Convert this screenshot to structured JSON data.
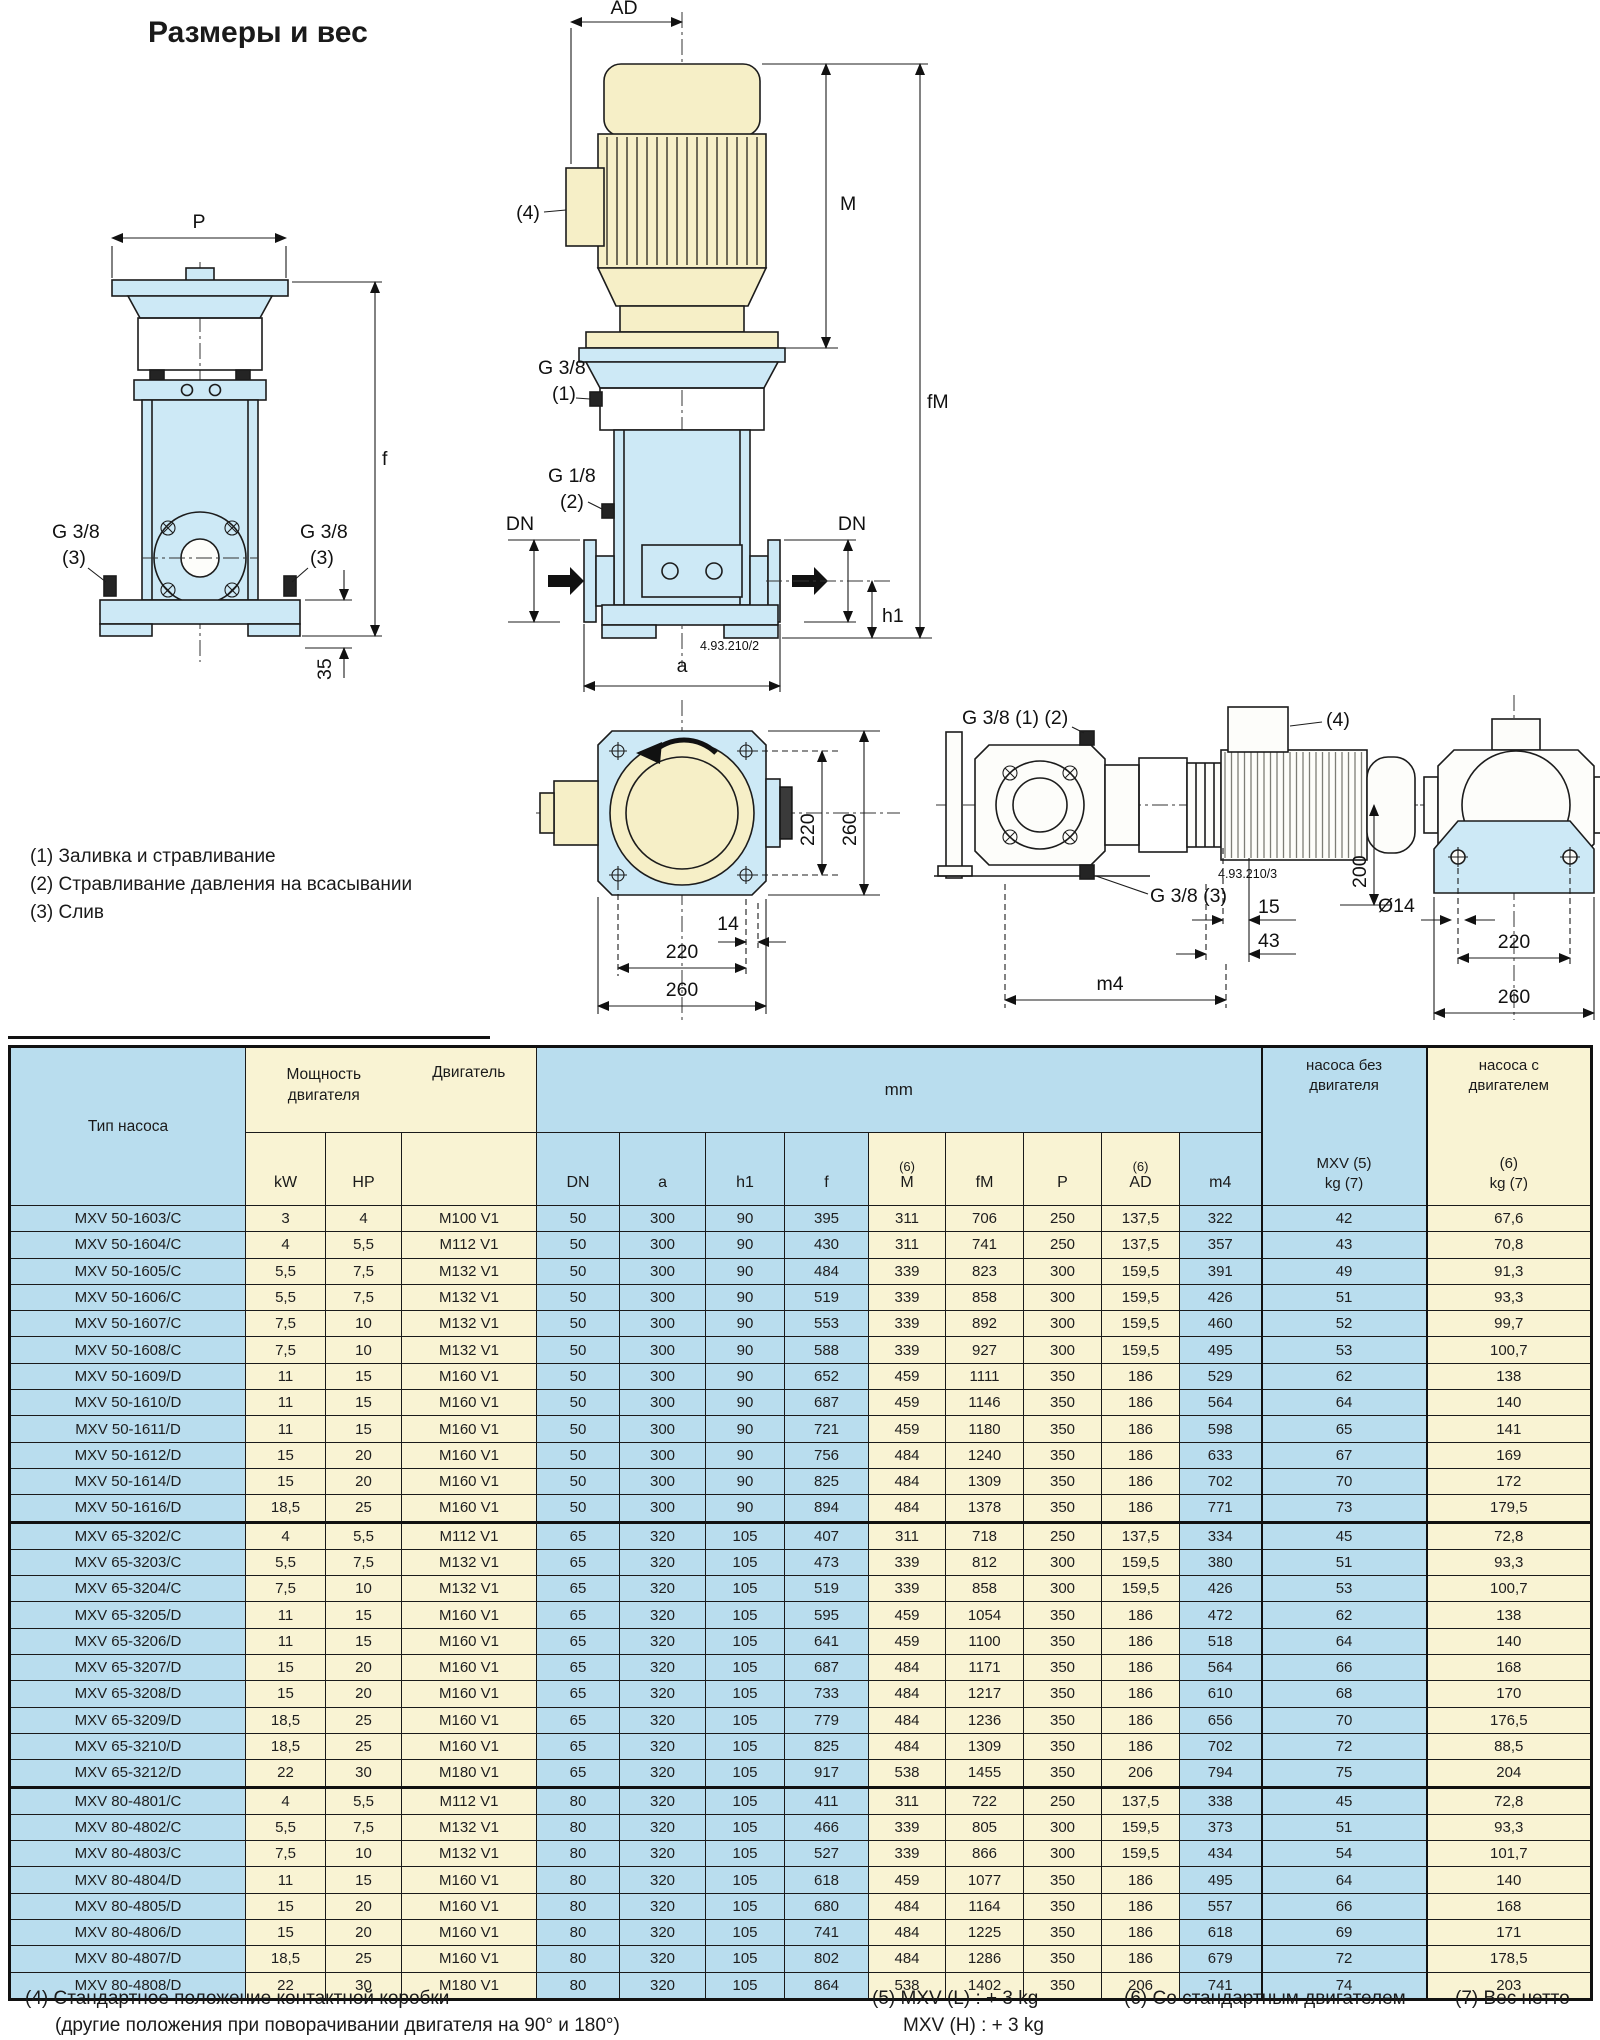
{
  "title": "Размеры и вес",
  "colors": {
    "table_blue": "#b9ddee",
    "table_cream": "#f9f3d3",
    "drawing_blue": "#cde9f6",
    "drawing_cream": "#f6efc7",
    "line": "#1c1c1c"
  },
  "notes": {
    "n1": "(1) Заливка и стравливание",
    "n2": "(2) Стравливание давления на всасывании",
    "n3": "(3) Слив"
  },
  "drawings": {
    "front": {
      "p": "P",
      "f": "f",
      "g38_left_1": "G 3/8",
      "g38_left_2": "(3)",
      "g38_right_1": "G 3/8",
      "g38_right_2": "(3)",
      "d35": "35"
    },
    "center": {
      "ad": "AD",
      "ref4": "(4)",
      "m": "M",
      "fm": "fM",
      "g38_1": "G 3/8",
      "g38_2": "(1)",
      "g18_1": "G 1/8",
      "g18_2": "(2)",
      "dn_left": "DN",
      "dn_right": "DN",
      "h1": "h1",
      "a": "a",
      "code": "4.93.210/2"
    },
    "plan": {
      "v220": "220",
      "v260": "260",
      "d14": "14",
      "h220": "220",
      "h260": "260"
    },
    "side": {
      "g38_12": "G 3/8 (1) (2)",
      "g38_3": "G 3/8 (3)",
      "ref4": "(4)",
      "code": "4.93.210/3",
      "d200": "200",
      "d15": "15",
      "d43": "43",
      "m4": "m4"
    },
    "endv": {
      "d14": "Ø14",
      "d220": "220",
      "d260": "260"
    }
  },
  "table": {
    "header": {
      "type": "Тип насоса",
      "power_l1": "Мощность",
      "power_l2": "двигателя",
      "motor": "Двигатель",
      "kw": "kW",
      "hp": "HP",
      "mm": "mm",
      "dn": "DN",
      "a": "a",
      "h1": "h1",
      "f": "f",
      "m_sup": "(6)",
      "m": "M",
      "fm": "fM",
      "p": "P",
      "ad_sup": "(6)",
      "ad": "AD",
      "m4": "m4",
      "kg1_l1": "насоса без",
      "kg1_l2": "двигателя",
      "kg1_l3": "MXV (5)",
      "kg1_l4": "kg (7)",
      "kg2_l1": "насоса с",
      "kg2_l2": "двигателем",
      "kg2_l3": "(6)",
      "kg2_l4": "kg (7)"
    },
    "groups": [
      [
        [
          "MXV 50-1603/C",
          "3",
          "4",
          "M100 V1",
          "50",
          "300",
          "90",
          "395",
          "311",
          "706",
          "250",
          "137,5",
          "322",
          "42",
          "67,6"
        ],
        [
          "MXV 50-1604/C",
          "4",
          "5,5",
          "M112 V1",
          "50",
          "300",
          "90",
          "430",
          "311",
          "741",
          "250",
          "137,5",
          "357",
          "43",
          "70,8"
        ],
        [
          "MXV 50-1605/C",
          "5,5",
          "7,5",
          "M132 V1",
          "50",
          "300",
          "90",
          "484",
          "339",
          "823",
          "300",
          "159,5",
          "391",
          "49",
          "91,3"
        ],
        [
          "MXV 50-1606/C",
          "5,5",
          "7,5",
          "M132 V1",
          "50",
          "300",
          "90",
          "519",
          "339",
          "858",
          "300",
          "159,5",
          "426",
          "51",
          "93,3"
        ],
        [
          "MXV 50-1607/C",
          "7,5",
          "10",
          "M132 V1",
          "50",
          "300",
          "90",
          "553",
          "339",
          "892",
          "300",
          "159,5",
          "460",
          "52",
          "99,7"
        ],
        [
          "MXV 50-1608/C",
          "7,5",
          "10",
          "M132 V1",
          "50",
          "300",
          "90",
          "588",
          "339",
          "927",
          "300",
          "159,5",
          "495",
          "53",
          "100,7"
        ],
        [
          "MXV 50-1609/D",
          "11",
          "15",
          "M160 V1",
          "50",
          "300",
          "90",
          "652",
          "459",
          "1111",
          "350",
          "186",
          "529",
          "62",
          "138"
        ],
        [
          "MXV 50-1610/D",
          "11",
          "15",
          "M160 V1",
          "50",
          "300",
          "90",
          "687",
          "459",
          "1146",
          "350",
          "186",
          "564",
          "64",
          "140"
        ],
        [
          "MXV 50-1611/D",
          "11",
          "15",
          "M160 V1",
          "50",
          "300",
          "90",
          "721",
          "459",
          "1180",
          "350",
          "186",
          "598",
          "65",
          "141"
        ],
        [
          "MXV 50-1612/D",
          "15",
          "20",
          "M160 V1",
          "50",
          "300",
          "90",
          "756",
          "484",
          "1240",
          "350",
          "186",
          "633",
          "67",
          "169"
        ],
        [
          "MXV 50-1614/D",
          "15",
          "20",
          "M160 V1",
          "50",
          "300",
          "90",
          "825",
          "484",
          "1309",
          "350",
          "186",
          "702",
          "70",
          "172"
        ],
        [
          "MXV 50-1616/D",
          "18,5",
          "25",
          "M160 V1",
          "50",
          "300",
          "90",
          "894",
          "484",
          "1378",
          "350",
          "186",
          "771",
          "73",
          "179,5"
        ]
      ],
      [
        [
          "MXV 65-3202/C",
          "4",
          "5,5",
          "M112 V1",
          "65",
          "320",
          "105",
          "407",
          "311",
          "718",
          "250",
          "137,5",
          "334",
          "45",
          "72,8"
        ],
        [
          "MXV 65-3203/C",
          "5,5",
          "7,5",
          "M132 V1",
          "65",
          "320",
          "105",
          "473",
          "339",
          "812",
          "300",
          "159,5",
          "380",
          "51",
          "93,3"
        ],
        [
          "MXV 65-3204/C",
          "7,5",
          "10",
          "M132 V1",
          "65",
          "320",
          "105",
          "519",
          "339",
          "858",
          "300",
          "159,5",
          "426",
          "53",
          "100,7"
        ],
        [
          "MXV 65-3205/D",
          "11",
          "15",
          "M160 V1",
          "65",
          "320",
          "105",
          "595",
          "459",
          "1054",
          "350",
          "186",
          "472",
          "62",
          "138"
        ],
        [
          "MXV 65-3206/D",
          "11",
          "15",
          "M160 V1",
          "65",
          "320",
          "105",
          "641",
          "459",
          "1100",
          "350",
          "186",
          "518",
          "64",
          "140"
        ],
        [
          "MXV 65-3207/D",
          "15",
          "20",
          "M160 V1",
          "65",
          "320",
          "105",
          "687",
          "484",
          "1171",
          "350",
          "186",
          "564",
          "66",
          "168"
        ],
        [
          "MXV 65-3208/D",
          "15",
          "20",
          "M160 V1",
          "65",
          "320",
          "105",
          "733",
          "484",
          "1217",
          "350",
          "186",
          "610",
          "68",
          "170"
        ],
        [
          "MXV 65-3209/D",
          "18,5",
          "25",
          "M160 V1",
          "65",
          "320",
          "105",
          "779",
          "484",
          "1236",
          "350",
          "186",
          "656",
          "70",
          "176,5"
        ],
        [
          "MXV 65-3210/D",
          "18,5",
          "25",
          "M160 V1",
          "65",
          "320",
          "105",
          "825",
          "484",
          "1309",
          "350",
          "186",
          "702",
          "72",
          "88,5"
        ],
        [
          "MXV 65-3212/D",
          "22",
          "30",
          "M180 V1",
          "65",
          "320",
          "105",
          "917",
          "538",
          "1455",
          "350",
          "206",
          "794",
          "75",
          "204"
        ]
      ],
      [
        [
          "MXV 80-4801/C",
          "4",
          "5,5",
          "M112 V1",
          "80",
          "320",
          "105",
          "411",
          "311",
          "722",
          "250",
          "137,5",
          "338",
          "45",
          "72,8"
        ],
        [
          "MXV 80-4802/C",
          "5,5",
          "7,5",
          "M132 V1",
          "80",
          "320",
          "105",
          "466",
          "339",
          "805",
          "300",
          "159,5",
          "373",
          "51",
          "93,3"
        ],
        [
          "MXV 80-4803/C",
          "7,5",
          "10",
          "M132 V1",
          "80",
          "320",
          "105",
          "527",
          "339",
          "866",
          "300",
          "159,5",
          "434",
          "54",
          "101,7"
        ],
        [
          "MXV 80-4804/D",
          "11",
          "15",
          "M160 V1",
          "80",
          "320",
          "105",
          "618",
          "459",
          "1077",
          "350",
          "186",
          "495",
          "64",
          "140"
        ],
        [
          "MXV 80-4805/D",
          "15",
          "20",
          "M160 V1",
          "80",
          "320",
          "105",
          "680",
          "484",
          "1164",
          "350",
          "186",
          "557",
          "66",
          "168"
        ],
        [
          "MXV 80-4806/D",
          "15",
          "20",
          "M160 V1",
          "80",
          "320",
          "105",
          "741",
          "484",
          "1225",
          "350",
          "186",
          "618",
          "69",
          "171"
        ],
        [
          "MXV 80-4807/D",
          "18,5",
          "25",
          "M160 V1",
          "80",
          "320",
          "105",
          "802",
          "484",
          "1286",
          "350",
          "186",
          "679",
          "72",
          "178,5"
        ],
        [
          "MXV 80-4808/D",
          "22",
          "30",
          "M180 V1",
          "80",
          "320",
          "105",
          "864",
          "538",
          "1402",
          "350",
          "206",
          "741",
          "74",
          "203"
        ]
      ]
    ]
  },
  "footnotes": {
    "f4_l1": "(4) Стандартное положение контактной коробки",
    "f4_l2": "(другие положения при поворачивании двигателя на 90° и 180°)",
    "f5_l1": "(5) MXV (L) : + 3 kg",
    "f5_l2": "MXV (H) : + 3 kg",
    "f6": "(6) Со стандартным двигателем",
    "f7": "(7) Вес нетто"
  }
}
